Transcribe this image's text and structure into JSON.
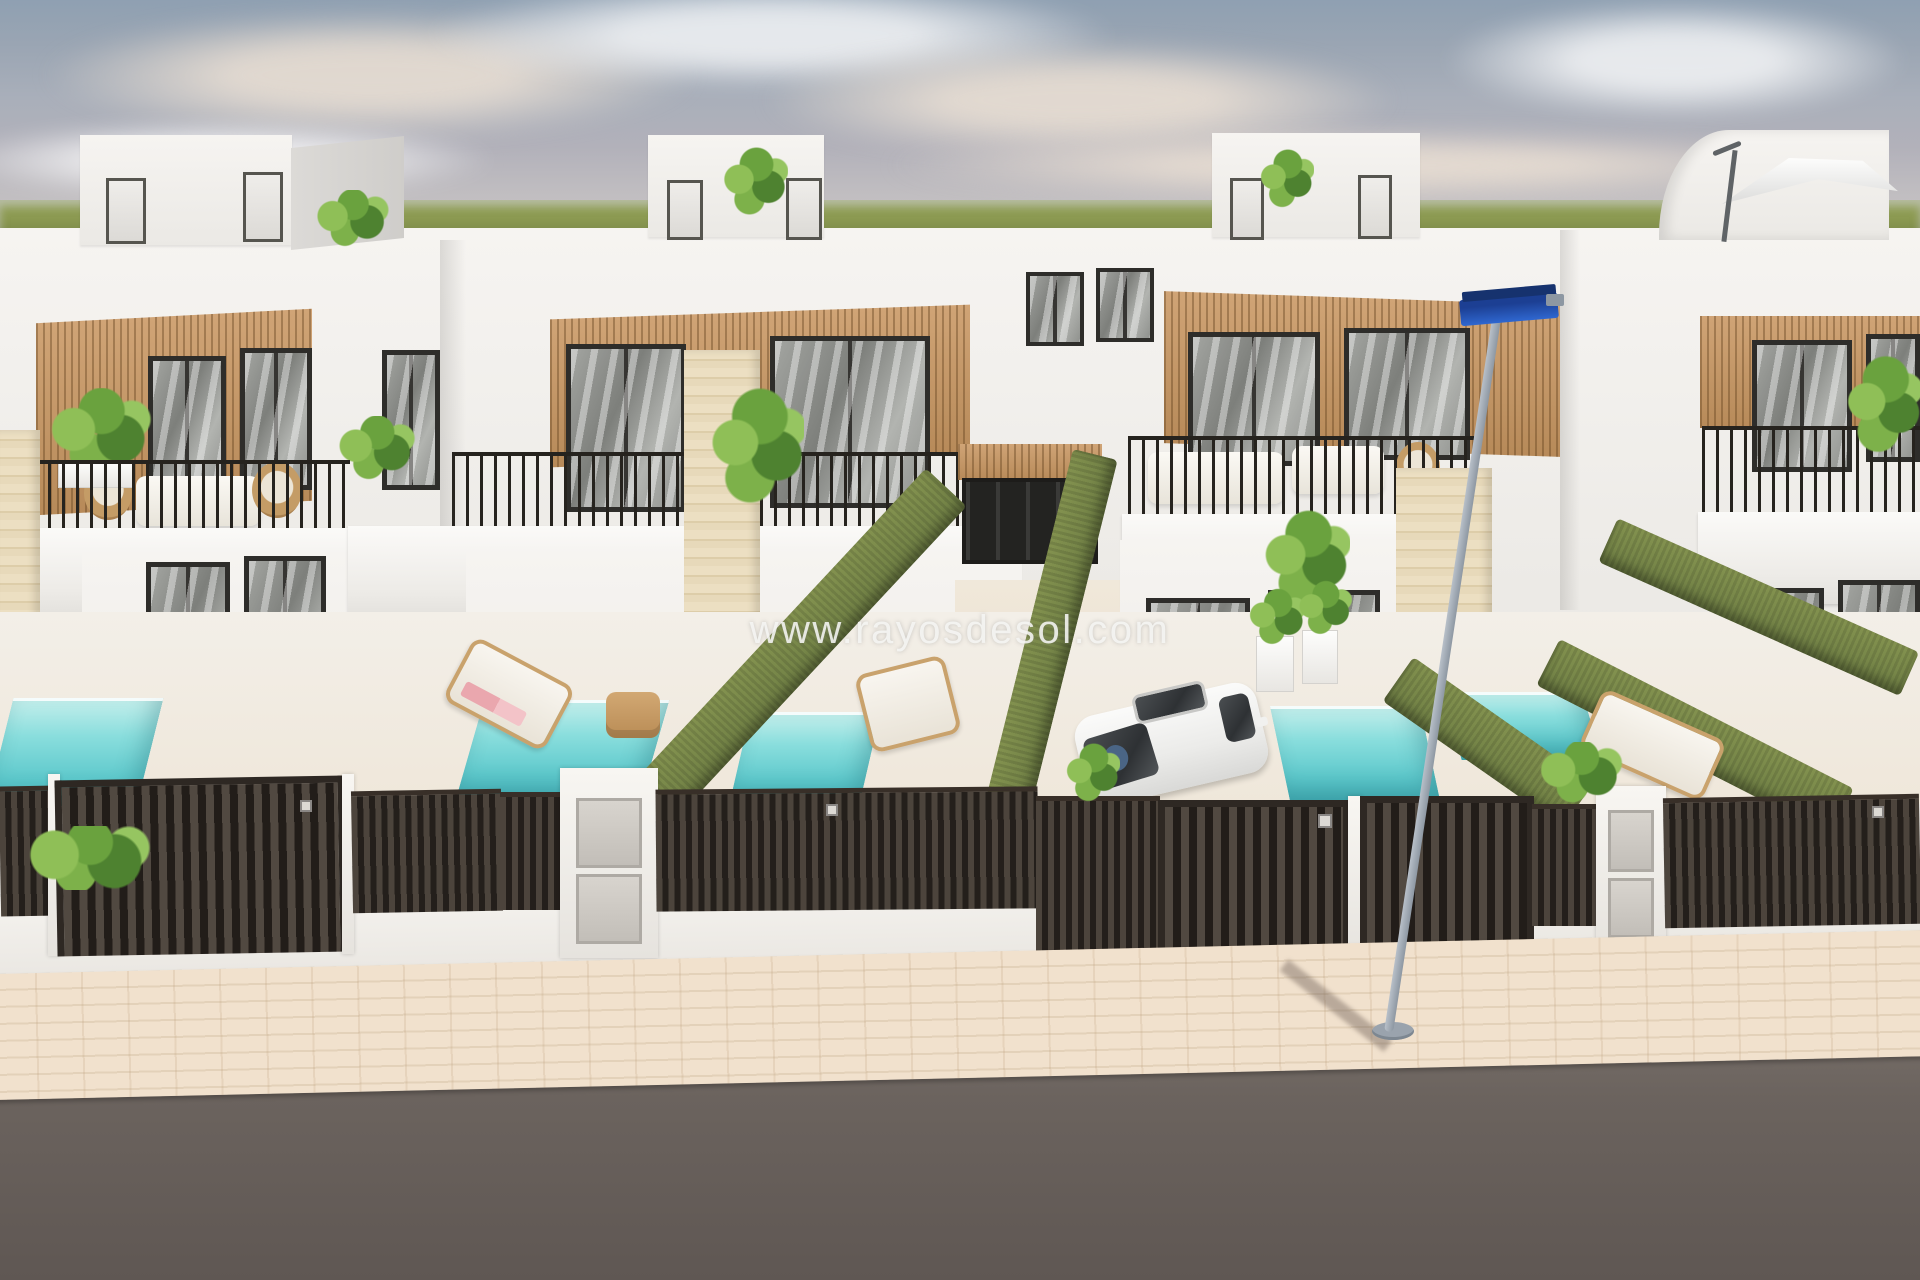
{
  "watermark": {
    "text": "www.rayosdesol.com"
  },
  "scene": {
    "subject": "3D architectural render of a row of modern two-storey white villas with rooftop terraces, wood-slat facade panels, private turquoise plunge pools, artificial-grass hedge walls, dark slatted gates and a street in the foreground",
    "inventory": [
      "sky with hazy clouds",
      "green field horizon",
      "rooftop stair bulkheads with plants",
      "cantilever parasol on roof terrace",
      "wood-slat facade panels",
      "dark framed glass doors",
      "black balcony railings",
      "outdoor sofas and wicker chairs",
      "turquoise plunge pools",
      "sun loungers with pink towels",
      "artificial-grass hedge walls",
      "travertine stone pillars",
      "dark slatted fences and gates",
      "white letterbox pillars with grey panels",
      "white hatchback car parked in driveway",
      "street lamp with blue fixture",
      "paved beige sidewalk",
      "asphalt road"
    ]
  },
  "palette": {
    "sky_top": "#8fa0b2",
    "sky_haze": "#c8c6c6",
    "grass": "#8b9951",
    "wall_white": "#f6f4f1",
    "wall_shadow": "#e2e0dc",
    "wood_slat": "#c59a6b",
    "window_frame": "#2e2d2a",
    "glass_grey": "#8b8d89",
    "hedge_green": "#78884d",
    "pool_turquoise": "#7ed7d8",
    "fence_dark": "#3a332e",
    "stone_beige": "#e6d7b8",
    "sidewalk": "#ecdac5",
    "road": "#6b635e",
    "lamp_blue": "#2f67d0",
    "car_white": "#f1f1ef",
    "towel_pink": "#eaa7ae",
    "lounger_wood": "#c9a26c"
  }
}
